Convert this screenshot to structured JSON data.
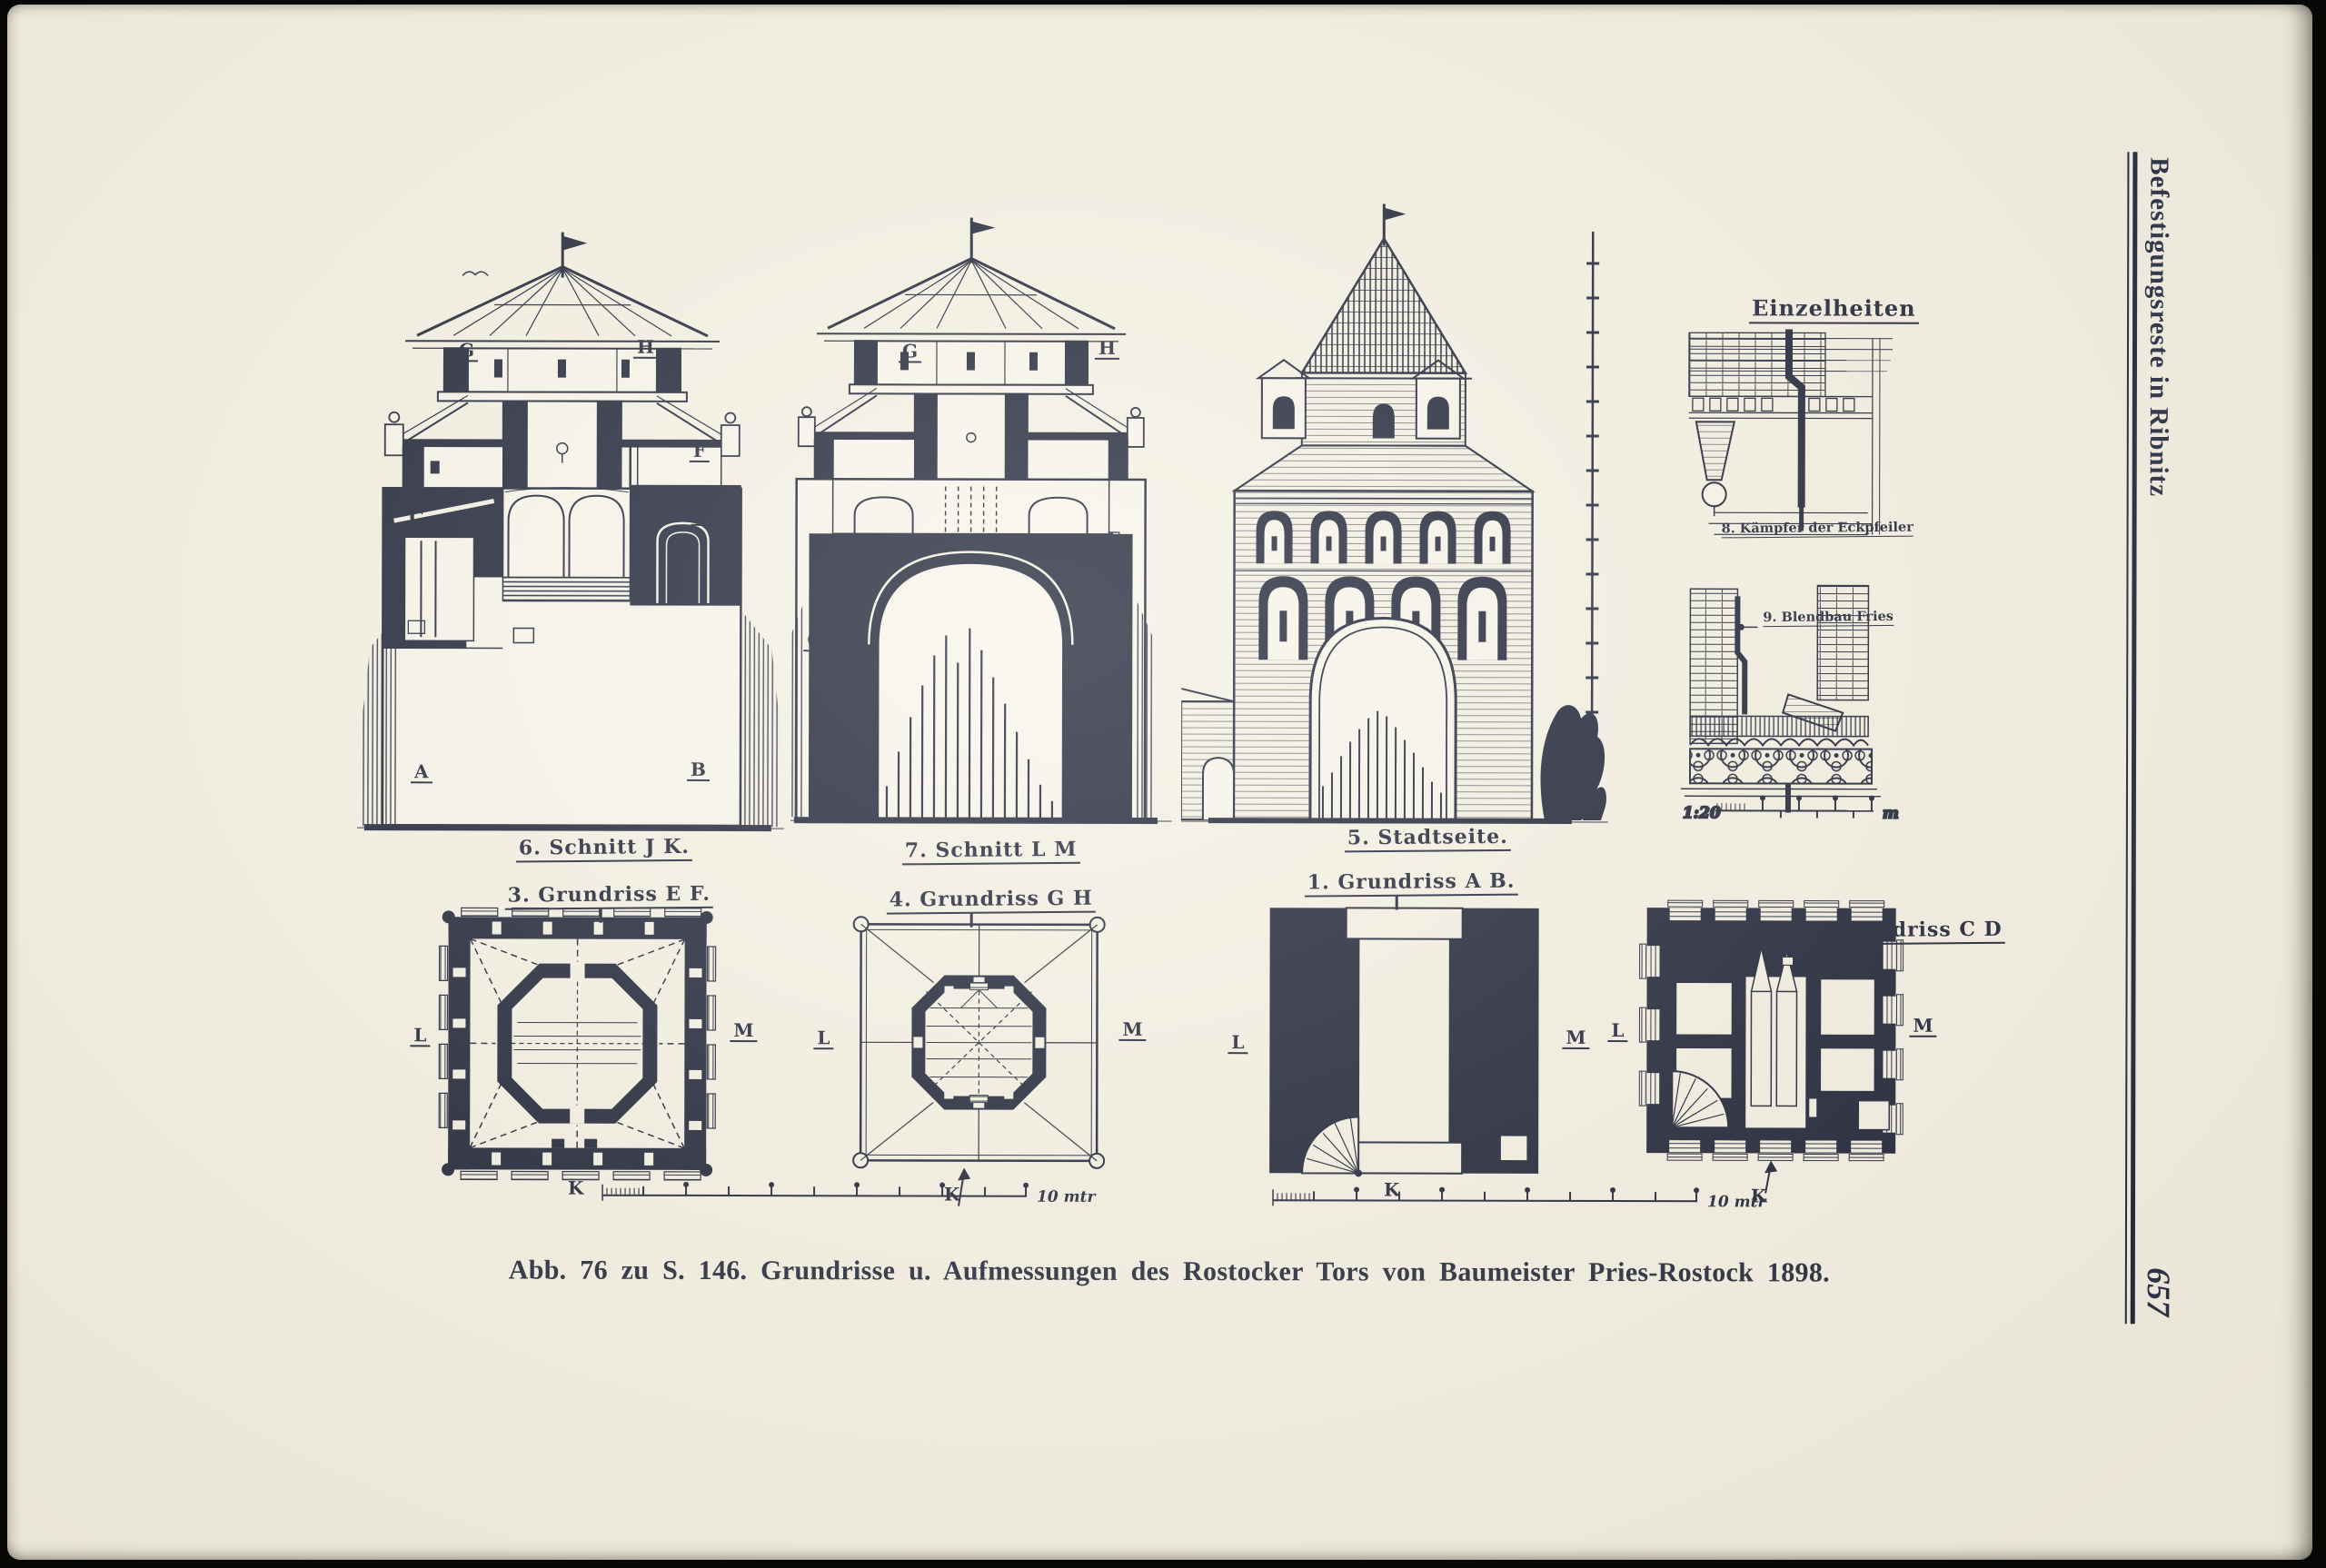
{
  "page": {
    "margin_title": "Befestigungsreste in Ribnitz",
    "page_number": "657",
    "caption": "Abb. 76 zu S. 146. Grundrisse u. Aufmessungen des Rostocker Tors von Baumeister Pries-Rostock 1898.",
    "colors": {
      "paper": "#f4f0e3",
      "ink": "#1d2235"
    }
  },
  "figures": {
    "section_jk": {
      "label": "6. Schnitt J K."
    },
    "section_lm": {
      "label": "7. Schnitt L M"
    },
    "stadtseite": {
      "label": "5. Stadtseite."
    },
    "details": {
      "title": "Einzelheiten",
      "label_8": "8. Kämpfer der Eckpfeiler",
      "label_9": "9. Blendbau Fries",
      "scale": "1:20",
      "scale_unit": "m"
    },
    "plan_ef": {
      "label": "3. Grundriss E F."
    },
    "plan_gh": {
      "label": "4. Grundriss G H"
    },
    "plan_ab": {
      "label": "1. Grundriss A B."
    },
    "plan_cd": {
      "label": "2. Grundriss C D"
    },
    "plan_scale": "10 mtr"
  },
  "letters": {
    "a": "A",
    "b": "B",
    "c": "C",
    "d": "D",
    "e": "E",
    "f": "F",
    "g": "G",
    "h": "H",
    "k": "K",
    "l": "L",
    "m": "M"
  }
}
